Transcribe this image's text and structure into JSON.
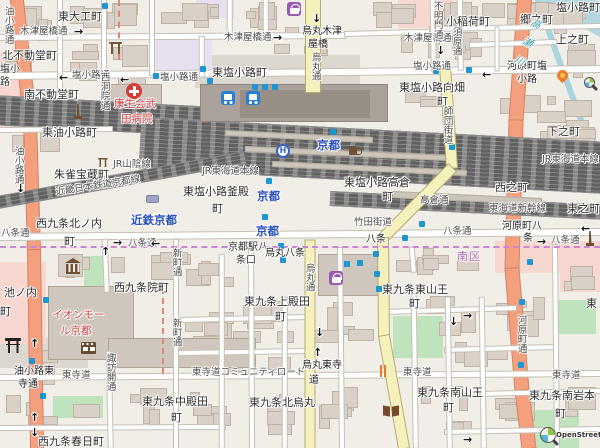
{
  "map": {
    "attribution": {
      "text": "OpenStreetMap"
    },
    "colors": {
      "trunk_road": "#f4a07e",
      "secondary_road": "#f5f1bd",
      "minor_road": "#ffffff",
      "railway": "#616161",
      "water": "#a9d3df",
      "park": "#bfe3bd",
      "station_label_blue": "#2b50bd",
      "poi_red": "#c73a36",
      "ward_purple": "#aa62b0",
      "marker_blue": "#1e96d2"
    },
    "labels": [
      {
        "t": "東大工町",
        "c": "pl",
        "x": 58,
        "y": 11
      },
      {
        "t": "木津屋橋通",
        "c": "st",
        "x": 20,
        "y": 27
      },
      {
        "t": "→",
        "c": "arr",
        "x": 74,
        "y": 26
      },
      {
        "t": "木津屋橋通",
        "c": "st",
        "x": 224,
        "y": 33
      },
      {
        "t": "→",
        "c": "arr",
        "x": 273,
        "y": 32
      },
      {
        "t": "木津屋橋通",
        "c": "st",
        "x": 404,
        "y": 34
      },
      {
        "t": "↓",
        "c": "arr",
        "x": 436,
        "y": 45
      },
      {
        "t": "烏丸木津",
        "c": "int",
        "x": 302,
        "y": 26
      },
      {
        "t": "屋橋",
        "c": "int",
        "x": 308,
        "y": 39
      },
      {
        "t": "↓",
        "c": "arr",
        "x": 312,
        "y": 13
      },
      {
        "t": "烏丸通",
        "c": "vst",
        "x": 309,
        "y": 52
      },
      {
        "t": "塩小路町",
        "c": "pl",
        "x": 556,
        "y": 2
      },
      {
        "t": "郷之町",
        "c": "pl",
        "x": 520,
        "y": 14
      },
      {
        "t": "小稲荷町",
        "c": "pl",
        "x": 446,
        "y": 16
      },
      {
        "t": "上之町",
        "c": "pl",
        "x": 556,
        "y": 34
      },
      {
        "t": "須原通",
        "c": "vst",
        "x": 450,
        "y": 27
      },
      {
        "t": "不明門通",
        "c": "vst",
        "x": 431,
        "y": 1
      },
      {
        "t": "北不動堂町",
        "c": "pl",
        "x": 2,
        "y": 50
      },
      {
        "t": "塩小",
        "c": "pls",
        "x": 0,
        "y": 64
      },
      {
        "t": "路",
        "c": "pls",
        "x": 0,
        "y": 77
      },
      {
        "t": "←",
        "c": "arr",
        "x": 59,
        "y": 72
      },
      {
        "t": "塩小路通",
        "c": "st",
        "x": 72,
        "y": 71
      },
      {
        "t": "←",
        "c": "arr",
        "x": 120,
        "y": 74
      },
      {
        "t": "塩小路通",
        "c": "st",
        "x": 160,
        "y": 73
      },
      {
        "t": "塩小路通",
        "c": "st",
        "x": 413,
        "y": 62
      },
      {
        "t": "←",
        "c": "arr",
        "x": 482,
        "y": 69
      },
      {
        "t": "東塩小路町",
        "c": "pl",
        "x": 212,
        "y": 67
      },
      {
        "t": "河原町塩",
        "c": "int",
        "x": 507,
        "y": 61
      },
      {
        "t": "小路",
        "c": "int",
        "x": 517,
        "y": 74
      },
      {
        "t": "南不動堂町",
        "c": "pl",
        "x": 24,
        "y": 89
      },
      {
        "t": "康生会武",
        "c": "red",
        "x": 114,
        "y": 99
      },
      {
        "t": "田病院",
        "c": "red",
        "x": 121,
        "y": 114
      },
      {
        "t": "東塩小路向畑",
        "c": "pl",
        "x": 399,
        "y": 82
      },
      {
        "t": "町",
        "c": "pl",
        "x": 437,
        "y": 96
      },
      {
        "t": "東油小路町",
        "c": "pl",
        "x": 42,
        "y": 127
      },
      {
        "t": "朱雀宝蔵町",
        "c": "pl",
        "x": 54,
        "y": 169
      },
      {
        "t": "JR山陰線",
        "c": "rail",
        "x": 113,
        "y": 160
      },
      {
        "t": "師団街道",
        "c": "vst",
        "x": 441,
        "y": 106
      },
      {
        "t": "高瀬川",
        "c": "riv",
        "x": 531,
        "y": 16
      },
      {
        "t": "下之町",
        "c": "pl",
        "x": 547,
        "y": 126
      },
      {
        "t": "東塩小路釜殿",
        "c": "pl",
        "x": 183,
        "y": 186
      },
      {
        "t": "町",
        "c": "pl",
        "x": 212,
        "y": 203
      },
      {
        "t": "東塩小路高倉",
        "c": "pl",
        "x": 344,
        "y": 177
      },
      {
        "t": "町",
        "c": "pl",
        "x": 382,
        "y": 191
      },
      {
        "t": "西之町",
        "c": "pl",
        "x": 495,
        "y": 182
      },
      {
        "t": "高倉通",
        "c": "st",
        "x": 420,
        "y": 196
      },
      {
        "t": "JR東海道本線",
        "c": "rail",
        "x": 202,
        "y": 167
      },
      {
        "t": "JR東海道本線",
        "c": "rail",
        "x": 542,
        "y": 155
      },
      {
        "t": "東海道新幹線",
        "c": "rail",
        "x": 489,
        "y": 204
      },
      {
        "t": "東之町",
        "c": "pl",
        "x": 567,
        "y": 203
      },
      {
        "t": "近畿日本鉄道京都線",
        "c": "rail",
        "x": 55,
        "y": 188,
        "r": -9
      },
      {
        "t": "近鉄京都",
        "c": "sta",
        "x": 131,
        "y": 214
      },
      {
        "t": "京都",
        "c": "sta",
        "x": 317,
        "y": 139
      },
      {
        "t": "京都",
        "c": "sta",
        "x": 257,
        "y": 190
      },
      {
        "t": "京都",
        "c": "sta",
        "x": 256,
        "y": 225
      },
      {
        "t": "西九条北ノ内",
        "c": "pl",
        "x": 36,
        "y": 218
      },
      {
        "t": "町",
        "c": "pl",
        "x": 64,
        "y": 236
      },
      {
        "t": "油小路通",
        "c": "vst",
        "x": 2,
        "y": 6
      },
      {
        "t": "油小路通",
        "c": "vst",
        "x": 12,
        "y": 146
      },
      {
        "t": "↓",
        "c": "arr",
        "x": 16,
        "y": 183
      },
      {
        "t": "西洞院通",
        "c": "vst",
        "x": 98,
        "y": 72
      },
      {
        "t": "八条通",
        "c": "st",
        "x": 1,
        "y": 229
      },
      {
        "t": "→",
        "c": "arr",
        "x": 113,
        "y": 237
      },
      {
        "t": "八条通",
        "c": "st",
        "x": 128,
        "y": 239
      },
      {
        "t": "←",
        "c": "arr",
        "x": 151,
        "y": 238
      },
      {
        "t": "八条通",
        "c": "st",
        "x": 443,
        "y": 227
      },
      {
        "t": "←",
        "c": "arr",
        "x": 581,
        "y": 223
      },
      {
        "t": "→",
        "c": "arr",
        "x": 537,
        "y": 236
      },
      {
        "t": "八条通",
        "c": "st",
        "x": 551,
        "y": 236
      },
      {
        "t": "竹田街道",
        "c": "st",
        "x": 354,
        "y": 218
      },
      {
        "t": "八条",
        "c": "int",
        "x": 366,
        "y": 234
      },
      {
        "t": "河原町八",
        "c": "int",
        "x": 502,
        "y": 221
      },
      {
        "t": "条",
        "c": "int",
        "x": 523,
        "y": 233
      },
      {
        "t": "京都駅八",
        "c": "pls",
        "x": 228,
        "y": 242
      },
      {
        "t": "条口",
        "c": "pls",
        "x": 236,
        "y": 255
      },
      {
        "t": "烏丸八条",
        "c": "int",
        "x": 265,
        "y": 248
      },
      {
        "t": "南区",
        "c": "ward",
        "x": 457,
        "y": 251
      },
      {
        "t": "西九条院町",
        "c": "pl",
        "x": 114,
        "y": 282
      },
      {
        "t": "東九条東山王",
        "c": "pl",
        "x": 382,
        "y": 284
      },
      {
        "t": "町",
        "c": "pl",
        "x": 409,
        "y": 298
      },
      {
        "t": "烏丸通",
        "c": "vst",
        "x": 303,
        "y": 263
      },
      {
        "t": "新町通",
        "c": "vst",
        "x": 170,
        "y": 248
      },
      {
        "t": "新町通",
        "c": "vst",
        "x": 170,
        "y": 318
      },
      {
        "t": "イオンモー",
        "c": "red",
        "x": 52,
        "y": 310
      },
      {
        "t": "ル京都",
        "c": "red",
        "x": 60,
        "y": 326
      },
      {
        "t": "東九条上殿田",
        "c": "pl",
        "x": 244,
        "y": 296
      },
      {
        "t": "町",
        "c": "pl",
        "x": 275,
        "y": 311
      },
      {
        "t": "池ノ内",
        "c": "pl",
        "x": 4,
        "y": 287
      },
      {
        "t": "町",
        "c": "pl",
        "x": 0,
        "y": 306
      },
      {
        "t": "河原町通",
        "c": "vst",
        "x": 515,
        "y": 315
      },
      {
        "t": "東",
        "c": "pl",
        "x": 586,
        "y": 298
      },
      {
        "t": "↑",
        "c": "arr",
        "x": 101,
        "y": 246
      },
      {
        "t": "↑",
        "c": "arr",
        "x": 30,
        "y": 338
      },
      {
        "t": "↑",
        "c": "arr",
        "x": 30,
        "y": 412
      },
      {
        "t": "↓",
        "c": "arr",
        "x": 30,
        "y": 427
      },
      {
        "t": "↓",
        "c": "arr",
        "x": 449,
        "y": 316
      },
      {
        "t": "→",
        "c": "arr",
        "x": 463,
        "y": 310
      },
      {
        "t": "→",
        "c": "arr",
        "x": 463,
        "y": 434
      },
      {
        "t": "↑",
        "c": "arr",
        "x": 313,
        "y": 347
      },
      {
        "t": "↓",
        "c": "arr",
        "x": 315,
        "y": 327
      },
      {
        "t": "諏訪開通",
        "c": "vst",
        "x": 104,
        "y": 353
      },
      {
        "t": "西九条春日町",
        "c": "pl",
        "x": 38,
        "y": 436
      },
      {
        "t": "油小路東",
        "c": "int",
        "x": 14,
        "y": 366
      },
      {
        "t": "寺通",
        "c": "int",
        "x": 18,
        "y": 379
      },
      {
        "t": "東寺道",
        "c": "st",
        "x": 62,
        "y": 371
      },
      {
        "t": "東寺道コミュニティロード",
        "c": "st",
        "x": 192,
        "y": 368
      },
      {
        "t": "烏丸東寺",
        "c": "int",
        "x": 302,
        "y": 360
      },
      {
        "t": "道",
        "c": "int",
        "x": 309,
        "y": 375
      },
      {
        "t": "東寺道",
        "c": "st",
        "x": 403,
        "y": 368
      },
      {
        "t": "東寺道",
        "c": "st",
        "x": 552,
        "y": 371
      },
      {
        "t": "東九条中殿田",
        "c": "pl",
        "x": 142,
        "y": 396
      },
      {
        "t": "町",
        "c": "pl",
        "x": 171,
        "y": 412
      },
      {
        "t": "東九条北烏丸",
        "c": "pl",
        "x": 249,
        "y": 397
      },
      {
        "t": "東九条南山王",
        "c": "pl",
        "x": 417,
        "y": 387
      },
      {
        "t": "町",
        "c": "pl",
        "x": 443,
        "y": 402
      },
      {
        "t": "東九条南岩本",
        "c": "pl",
        "x": 529,
        "y": 390
      },
      {
        "t": "町",
        "c": "pl",
        "x": 555,
        "y": 408
      }
    ],
    "icons": [
      {
        "name": "hospital-icon",
        "x": 126,
        "y": 83
      },
      {
        "name": "shrine-icon",
        "x": 109,
        "y": 42
      },
      {
        "name": "shrine-icon",
        "x": 98,
        "y": 158,
        "small": true
      },
      {
        "name": "monument-icon",
        "x": 73,
        "y": 104
      },
      {
        "name": "monument-icon",
        "x": 585,
        "y": 231
      },
      {
        "name": "shopping-bag-icon",
        "x": 287,
        "y": 2
      },
      {
        "name": "shopping-bag-icon",
        "x": 329,
        "y": 271
      },
      {
        "name": "hotel-icon",
        "x": 276,
        "y": 144
      },
      {
        "name": "pub-icon",
        "x": 348,
        "y": 144
      },
      {
        "name": "museum-icon",
        "x": 65,
        "y": 258
      },
      {
        "name": "cinema-icon",
        "x": 81,
        "y": 342
      },
      {
        "name": "torii-icon",
        "x": 5,
        "y": 338
      },
      {
        "name": "book-icon",
        "x": 383,
        "y": 406
      },
      {
        "name": "flame-icon",
        "x": 557,
        "y": 70
      },
      {
        "name": "restaurant-icon",
        "x": 378,
        "y": 365
      },
      {
        "name": "bus-station-icon",
        "x": 221,
        "y": 91
      },
      {
        "name": "bus-station-icon",
        "x": 246,
        "y": 91
      },
      {
        "name": "station-platform-icon",
        "x": 146,
        "y": 195
      },
      {
        "name": "blue-marker-icon",
        "x": 200,
        "y": 66
      },
      {
        "name": "blue-marker-icon",
        "x": 26,
        "y": 92
      },
      {
        "name": "blue-marker-icon",
        "x": 433,
        "y": 68
      },
      {
        "name": "blue-marker-icon",
        "x": 466,
        "y": 67
      },
      {
        "name": "blue-marker-icon",
        "x": 207,
        "y": 78
      },
      {
        "name": "blue-marker-icon",
        "x": 252,
        "y": 84
      },
      {
        "name": "blue-marker-icon",
        "x": 262,
        "y": 84
      },
      {
        "name": "blue-marker-icon",
        "x": 272,
        "y": 84
      },
      {
        "name": "blue-marker-icon",
        "x": 330,
        "y": 129
      },
      {
        "name": "blue-marker-icon",
        "x": 266,
        "y": 178
      },
      {
        "name": "blue-marker-icon",
        "x": 262,
        "y": 214
      },
      {
        "name": "blue-marker-icon",
        "x": 278,
        "y": 243
      },
      {
        "name": "blue-marker-icon",
        "x": 280,
        "y": 257
      },
      {
        "name": "blue-marker-icon",
        "x": 344,
        "y": 261
      },
      {
        "name": "blue-marker-icon",
        "x": 357,
        "y": 260
      },
      {
        "name": "blue-marker-icon",
        "x": 373,
        "y": 251
      },
      {
        "name": "blue-marker-icon",
        "x": 374,
        "y": 271
      },
      {
        "name": "blue-marker-icon",
        "x": 376,
        "y": 286
      },
      {
        "name": "blue-marker-icon",
        "x": 419,
        "y": 221
      },
      {
        "name": "blue-marker-icon",
        "x": 402,
        "y": 235
      },
      {
        "name": "blue-marker-icon",
        "x": 527,
        "y": 259
      },
      {
        "name": "blue-marker-icon",
        "x": 519,
        "y": 299
      },
      {
        "name": "blue-marker-icon",
        "x": 518,
        "y": 362
      },
      {
        "name": "blue-marker-icon",
        "x": 29,
        "y": 358
      },
      {
        "name": "blue-marker-icon",
        "x": 40,
        "y": 393
      },
      {
        "name": "blue-marker-icon",
        "x": 43,
        "y": 297
      },
      {
        "name": "blue-marker-icon",
        "x": 449,
        "y": 144
      },
      {
        "name": "blue-marker-icon",
        "x": 584,
        "y": 7
      },
      {
        "name": "blue-marker-icon",
        "x": 102,
        "y": 3
      },
      {
        "name": "blue-marker-icon",
        "x": 153,
        "y": 73
      }
    ]
  }
}
